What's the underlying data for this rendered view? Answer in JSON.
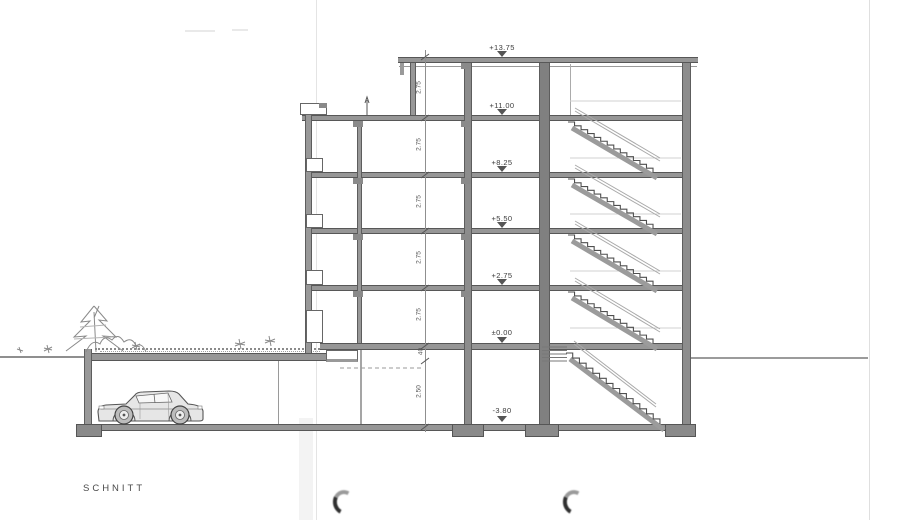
{
  "drawing_title": "SCHNITT",
  "elevations": [
    {
      "name": "roof",
      "label": "+13.75"
    },
    {
      "name": "attic-floor",
      "label": "+11.00"
    },
    {
      "name": "third-floor",
      "label": "+8.25"
    },
    {
      "name": "second-floor",
      "label": "+5.50"
    },
    {
      "name": "first-floor",
      "label": "+2.75"
    },
    {
      "name": "ground-floor",
      "label": "±0.00"
    },
    {
      "name": "basement",
      "label": "-3.80"
    }
  ],
  "dimensions": {
    "story_heights": [
      "2.75",
      "2.75",
      "2.75",
      "2.75",
      "2.75"
    ],
    "ground_slab_offset": "40",
    "basement_height": "2.50"
  },
  "icons": {
    "elevation_marker": "height-datum-triangle",
    "punch_hole": "binder-punch-crescent"
  },
  "colors": {
    "paper": "#ffffff",
    "ink": "#4f4f4f",
    "concrete_fill": "#969696",
    "faint_line": "#cccccc"
  }
}
